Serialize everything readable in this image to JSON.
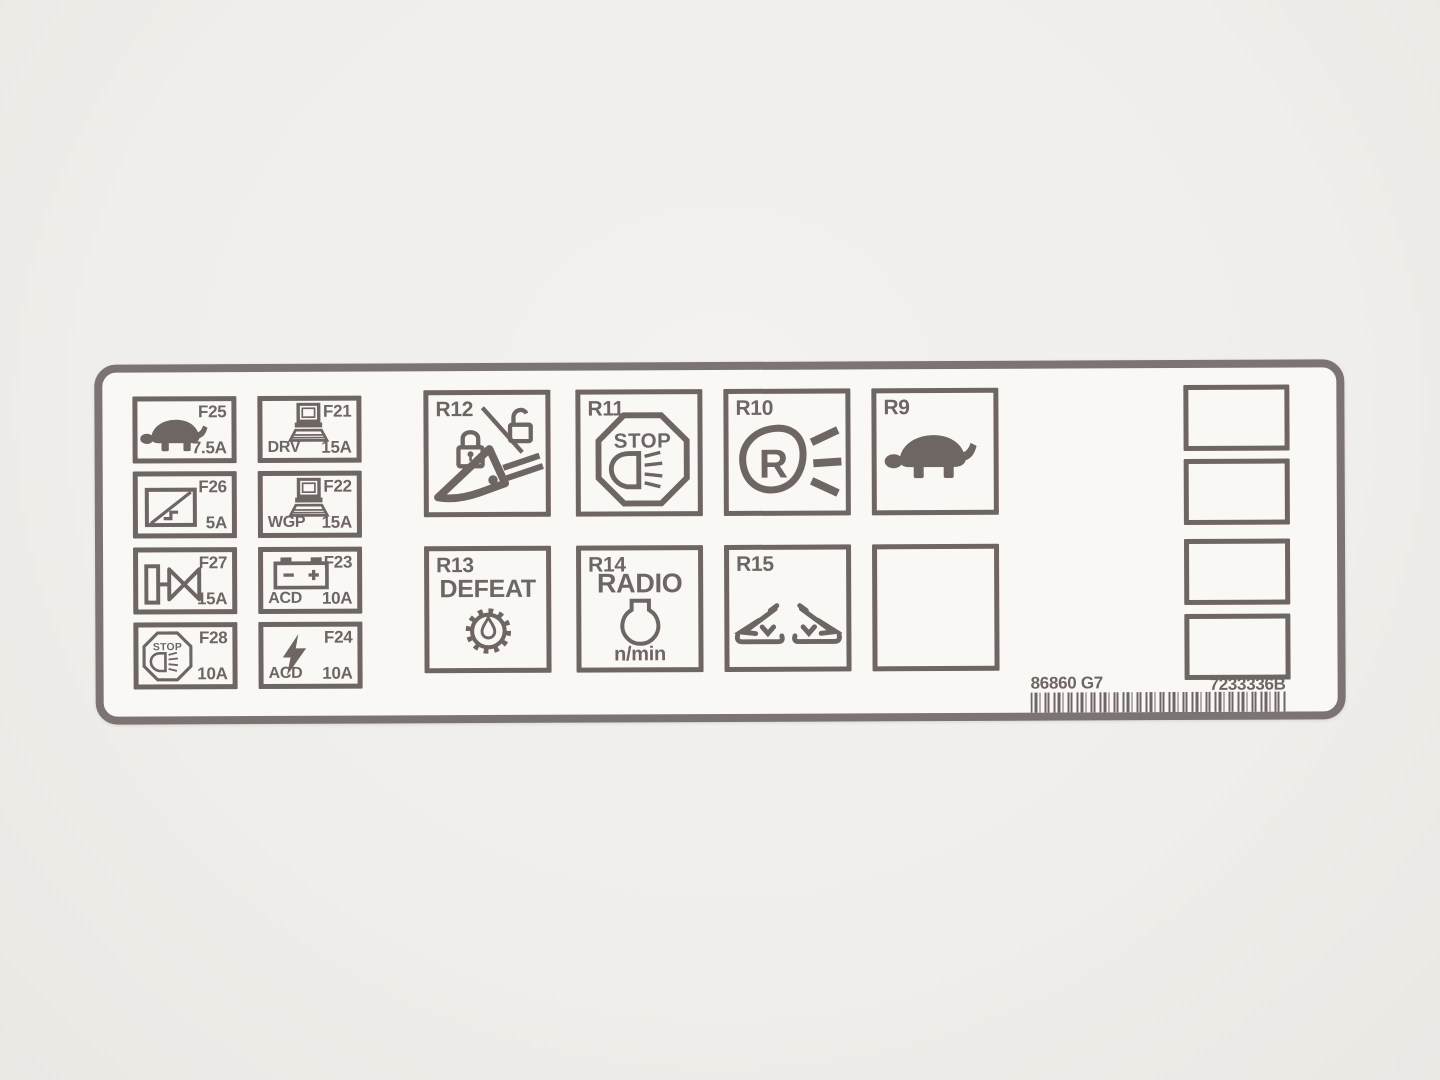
{
  "colors": {
    "ink": "#6e6663",
    "frame": "#7b7472",
    "label_bg": "#faf8f5",
    "page_bg": "#f0eeea"
  },
  "label": {
    "fuses": [
      {
        "id": "F25",
        "amp": "7.5A",
        "icon": "turtle"
      },
      {
        "id": "F26",
        "amp": "5A",
        "icon": "window-dimmer"
      },
      {
        "id": "F27",
        "amp": "15A",
        "icon": "solenoid-valve"
      },
      {
        "id": "F28",
        "amp": "10A",
        "icon": "stop-lamp",
        "icon_text": "STOP"
      },
      {
        "id": "F21",
        "amp": "15A",
        "sub": "DRV",
        "icon": "computer"
      },
      {
        "id": "F22",
        "amp": "15A",
        "sub": "WGP",
        "icon": "computer"
      },
      {
        "id": "F23",
        "amp": "10A",
        "sub": "ACD",
        "icon": "battery"
      },
      {
        "id": "F24",
        "amp": "10A",
        "sub": "ACD",
        "icon": "lightning-bolt"
      }
    ],
    "relays": {
      "r12": {
        "id": "R12",
        "icon": "locks-and-lever"
      },
      "r11": {
        "id": "R11",
        "icon": "stop-lamp",
        "icon_text": "STOP"
      },
      "r10": {
        "id": "R10",
        "icon": "reverse-lamp",
        "icon_text": "R"
      },
      "r9": {
        "id": "R9",
        "icon": "turtle"
      },
      "r13": {
        "id": "R13",
        "label": "DEFEAT",
        "icon": "gear-droplet"
      },
      "r14": {
        "id": "R14",
        "label": "RADIO",
        "sub": "n/min",
        "icon": "bulb"
      },
      "r15": {
        "id": "R15",
        "icon": "seats"
      }
    },
    "footer": {
      "part_left": "86860 G7",
      "part_right": "7233336B"
    }
  }
}
